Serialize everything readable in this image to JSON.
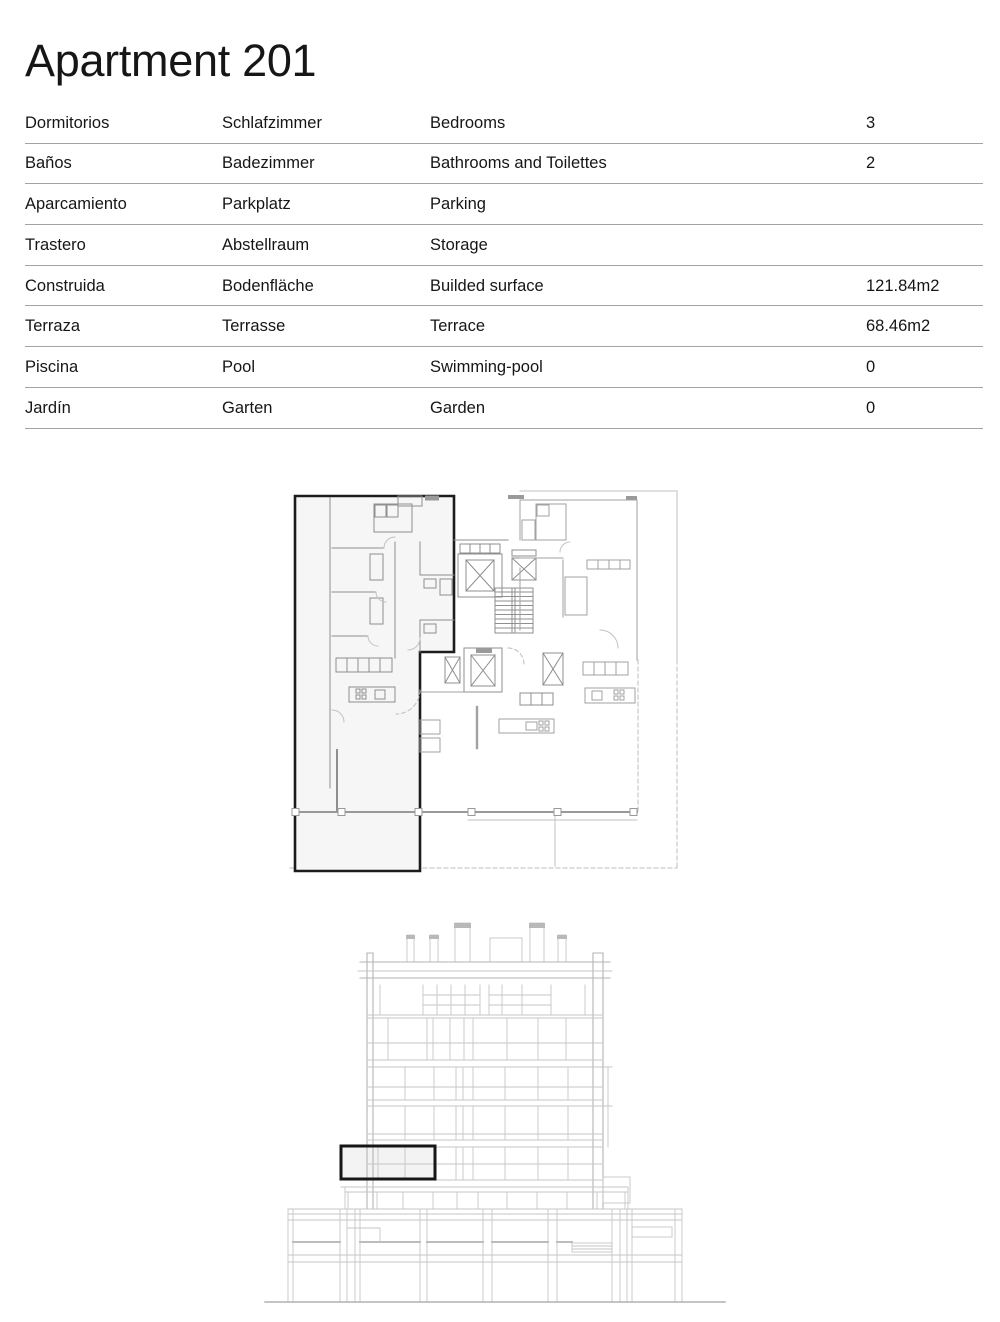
{
  "page": {
    "title": "Apartment 201"
  },
  "spec_table": {
    "rows": [
      {
        "es": "Dormitorios",
        "de": "Schlafzimmer",
        "en": "Bedrooms",
        "value": "3"
      },
      {
        "es": "Baños",
        "de": "Badezimmer",
        "en": "Bathrooms and Toilettes",
        "value": "2"
      },
      {
        "es": "Aparcamiento",
        "de": "Parkplatz",
        "en": "Parking",
        "value": ""
      },
      {
        "es": "Trastero",
        "de": "Abstellraum",
        "en": "Storage",
        "value": ""
      },
      {
        "es": "Construida",
        "de": "Bodenfläche",
        "en": "Builded surface",
        "value": "121.84m2"
      },
      {
        "es": "Terraza",
        "de": "Terrasse",
        "en": "Terrace",
        "value": "68.46m2"
      },
      {
        "es": "Piscina",
        "de": "Pool",
        "en": "Swimming-pool",
        "value": "0"
      },
      {
        "es": "Jardín",
        "de": "Garten",
        "en": "Garden",
        "value": "0"
      }
    ]
  },
  "figures": {
    "floor_plan": {
      "highlight_outline_color": "#1c1c1c",
      "highlight_fill": "#f6f6f6",
      "wall_color": "#8f8f8f",
      "light_line_color": "#c2c2c2"
    },
    "elevation": {
      "highlight_outline_color": "#161616",
      "highlight_fill": "#f3f3f3",
      "line_color": "#c6c6c6"
    }
  }
}
